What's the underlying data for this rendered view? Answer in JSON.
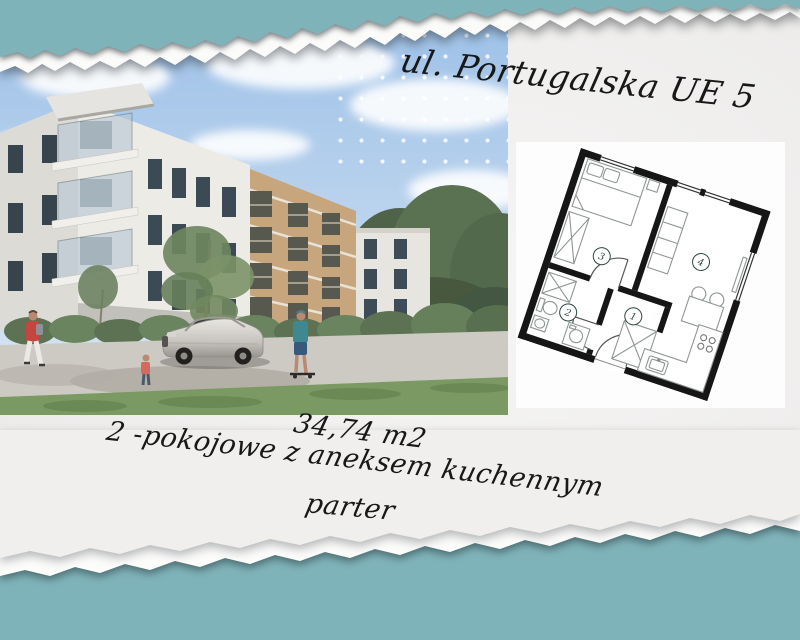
{
  "flyer": {
    "title": "ul. Portugalska UE 5",
    "area": "34,74 m2",
    "description": "2 -pokojowe z aneksem kuchennym",
    "floor": "parter"
  },
  "floor_plan": {
    "rooms": [
      {
        "number": "1"
      },
      {
        "number": "2"
      },
      {
        "number": "3"
      },
      {
        "number": "4"
      }
    ]
  },
  "colors": {
    "teal": "#7fb3ba",
    "paper": "#f0efee",
    "card_white": "#fdfdfd",
    "ink": "#181818",
    "plan_walls": "#161616",
    "room_circle": "#2c4440"
  }
}
